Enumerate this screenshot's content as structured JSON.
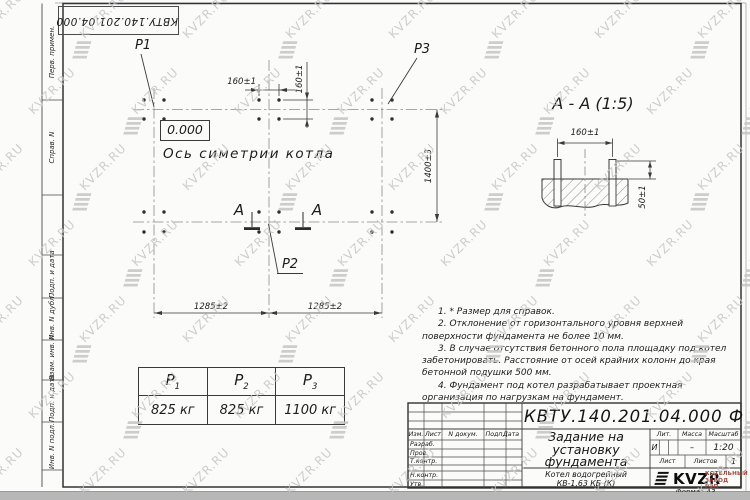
{
  "doc_number": "КВТУ.140.201.04.000  Ф",
  "margin_labels": [
    "Перв. примен.",
    "Справ. N",
    "Подп. и дата",
    "Инв. N дубл.",
    "Взам. инв. N",
    "Подп. и дата",
    "Инв. N подл."
  ],
  "plan": {
    "label_p1": "P1",
    "label_p2": "P2",
    "label_p3": "P3",
    "elevation": "0.000",
    "axis_label": "Ось симетрии котла",
    "dim_bolt_h": "160±1",
    "dim_bolt_v": "160±1",
    "dim_width": "1400±3",
    "dim_span_left": "1285±2",
    "dim_span_right": "1285±2",
    "section_letter_left": "А",
    "section_letter_right": "А"
  },
  "section": {
    "title": "А - А (1:5)",
    "dim_bolts": "160±1",
    "dim_height": "50±1"
  },
  "notes": [
    "1. * Размер для справок.",
    "2. Отклонение от горизонтального уровня верхней поверхности фундамента не более 10 мм.",
    "3. В случае отсутствия бетонного пола площадку под котел забетонировать. Расстояние от осей крайних колонн до края бетонной подушки 500 мм.",
    "4. Фундамент под котел разрабатывает проектная организация по нагрузкам на фундамент."
  ],
  "load_table": {
    "headers": [
      {
        "base": "P",
        "sub": "1"
      },
      {
        "base": "P",
        "sub": "2"
      },
      {
        "base": "P",
        "sub": "3"
      }
    ],
    "values": [
      "825 кг",
      "825 кг",
      "1100 кг"
    ]
  },
  "title_block": {
    "title_lines": [
      "Задание на",
      "установку",
      "фундамента"
    ],
    "product_lines": [
      "Котел водогрейный",
      "КВ-1,63 КБ (К)"
    ],
    "col_headers": {
      "izm": "Изм.",
      "list": "Лист",
      "doc": "N докум.",
      "podp": "Подп.",
      "data": "Дата"
    },
    "row_labels": [
      "Разраб.",
      "Пров.",
      "Т.контр.",
      "Н.контр.",
      "Утв."
    ],
    "lit_header": "Лит.",
    "mass_header": "Масса",
    "scale_header": "Масштаб",
    "lit_value": "И",
    "mass_value": "–",
    "scale_value": "1:20",
    "sheet_label": "Лист",
    "sheets_label": "Листов",
    "sheets_value": "1",
    "logo_text": "KVZR",
    "company_lines": [
      "КОТЕЛЬНЫЙ",
      "ЗАВОД РЭП"
    ],
    "format_label": "Формат А3"
  },
  "watermark": {
    "text": "KVZR.RU"
  },
  "colors": {
    "line": "#3a3a3a",
    "watermark": "#c6c6c6",
    "accent_red": "#99473a"
  }
}
